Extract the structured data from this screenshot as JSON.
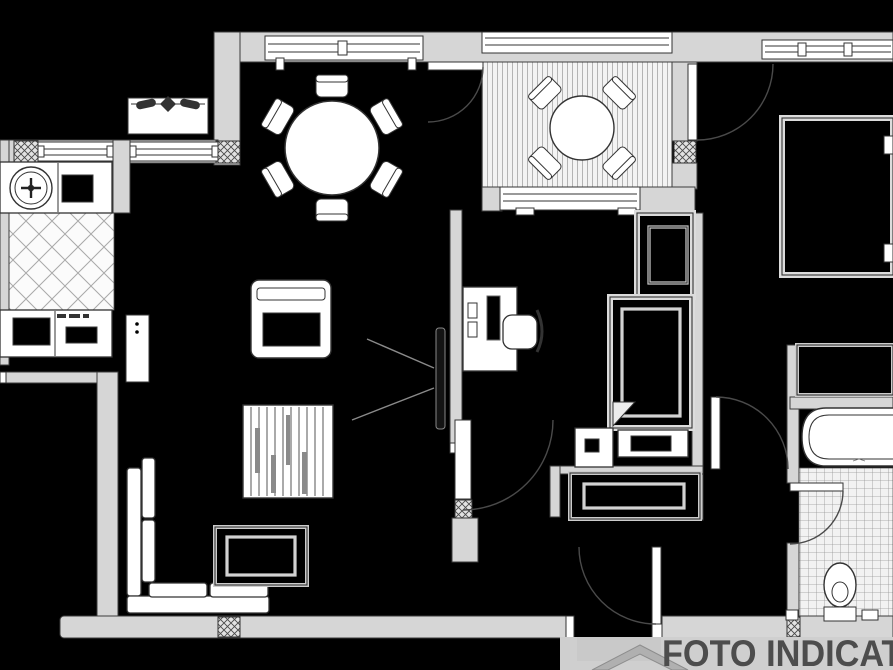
{
  "image": {
    "kind": "apartment floor plan drawing",
    "width": 893,
    "height": 670,
    "background": "#000000"
  },
  "watermark": {
    "text": "FOTO INDICATI",
    "color": "#4d4d4d",
    "band_color": "#cfcfcf",
    "logo": "house-roof-icon"
  },
  "palette": {
    "wall_fill": "#d6d6d6",
    "outline": "#3c3c3c",
    "fixture_fill": "#ffffff",
    "room_fill": "#000000",
    "tile_line": "#999999"
  },
  "rooms": {
    "kitchen": {
      "features": [
        "round-sink",
        "cooktop",
        "counters",
        "diamond-tiled-floor",
        "open-door-leaf",
        "windows"
      ]
    },
    "dining_area": {
      "features": [
        "round-table",
        "six-chairs",
        "window"
      ]
    },
    "terrace": {
      "features": [
        "decked-floor",
        "round-table",
        "four-chairs",
        "railing",
        "door"
      ]
    },
    "living_area": {
      "features": [
        "l-shaped-sofa",
        "coffee-table",
        "armchair",
        "slatted-cabinet",
        "wall-tv"
      ]
    },
    "bedroom": {
      "features": [
        "desk",
        "monitor",
        "office-chair",
        "wardrobe",
        "bed",
        "nightstand",
        "bench",
        "sideboard",
        "window",
        "door"
      ]
    },
    "second_bedroom": {
      "features": [
        "built-in-closet",
        "window",
        "door-from-terrace"
      ]
    },
    "bathroom": {
      "features": [
        "bathtub",
        "toilet",
        "grid-tiled-floor",
        "door"
      ]
    },
    "hallway": {
      "features": [
        "entrance-door",
        "interior-doors"
      ]
    },
    "balcony": {
      "features": [
        "flower-planter"
      ]
    }
  }
}
